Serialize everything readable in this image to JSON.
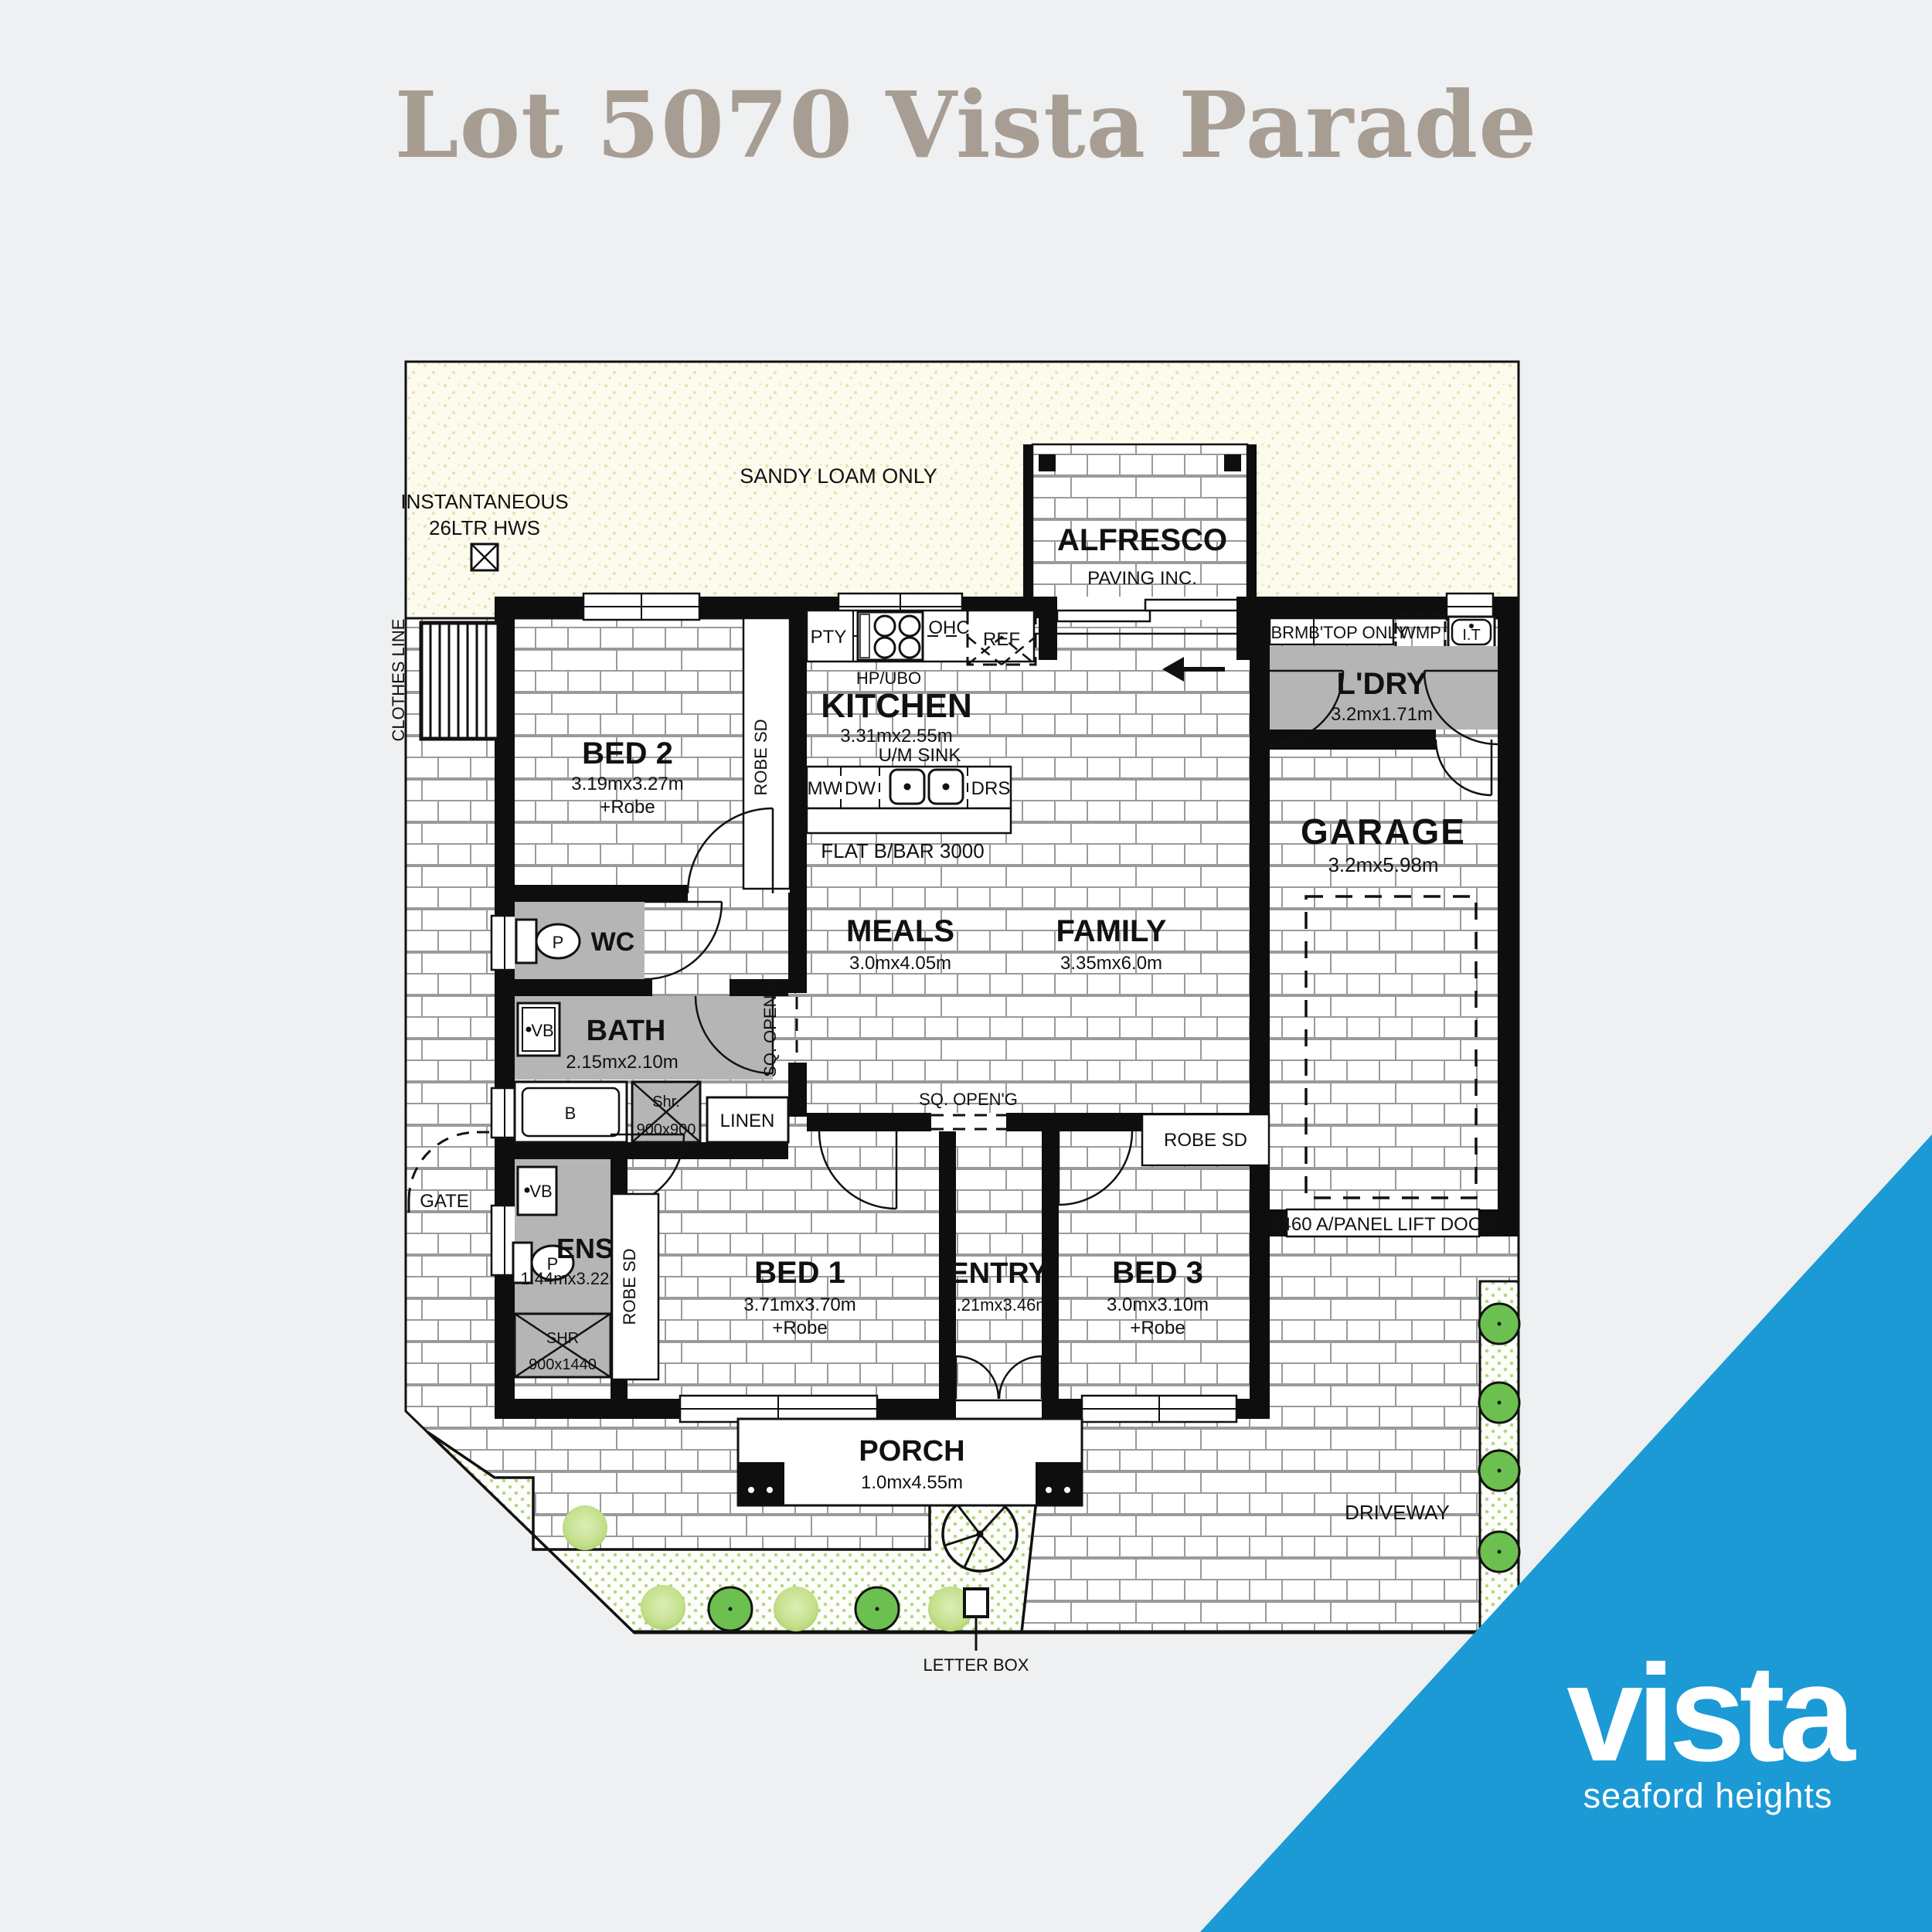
{
  "title": "Lot 5070 Vista Parade",
  "logo": {
    "brand": "vista",
    "tagline": "seaford heights"
  },
  "site": {
    "sandy_loam": "SANDY LOAM ONLY",
    "clothes_line": "CLOTHES LINE",
    "hws_line1": "INSTANTANEOUS",
    "hws_line2": "26LTR HWS",
    "gate": "GATE",
    "driveway": "DRIVEWAY",
    "letter_box": "LETTER BOX",
    "lift_door": "2460 A/PANEL LIFT DOOR"
  },
  "rooms": {
    "alfresco": {
      "name": "ALFRESCO",
      "note": "PAVING INC.",
      "dims": "3.43mx2.73m"
    },
    "kitchen": {
      "name": "KITCHEN",
      "dims": "3.31mx2.55m",
      "note1": "HP/UBO",
      "note2": "U/M SINK",
      "bar": "FLAT B/BAR  3000"
    },
    "bed2": {
      "name": "BED 2",
      "dims": "3.19mx3.27m",
      "extra": "+Robe"
    },
    "wc": {
      "name": "WC"
    },
    "bath": {
      "name": "BATH",
      "dims": "2.15mx2.10m"
    },
    "ens": {
      "name": "ENS",
      "dims": "1.44mx3.22m"
    },
    "bed1": {
      "name": "BED 1",
      "dims": "3.71mx3.70m",
      "extra": "+Robe"
    },
    "entry": {
      "name": "ENTRY",
      "dims": "1.21mx3.46m"
    },
    "bed3": {
      "name": "BED 3",
      "dims": "3.0mx3.10m",
      "extra": "+Robe"
    },
    "meals": {
      "name": "MEALS",
      "dims": "3.0mx4.05m"
    },
    "family": {
      "name": "FAMILY",
      "dims": "3.35mx6.0m"
    },
    "ldry": {
      "name": "L'DRY",
      "dims": "3.2mx1.71m"
    },
    "garage": {
      "name": "GARAGE",
      "dims": "3.2mx5.98m"
    },
    "porch": {
      "name": "PORCH",
      "dims": "1.0mx4.55m"
    },
    "linen": "LINEN"
  },
  "fixtures": {
    "pty": "PTY",
    "ohc": "OHC",
    "ref": "REF",
    "mw": "MW",
    "dw": "DW",
    "drs": "DRS",
    "brm": "BRM.",
    "btop": "B'TOP ONLY",
    "wmp": "WMP",
    "it": "I.T",
    "robe_sd": "ROBE SD",
    "sq_open": "SQ. OPEN'G",
    "shr_small": "Shr.",
    "shr_small_dims": "900x900",
    "shr": "SHR",
    "shr_dims": "900x1440",
    "bath_tub": "B",
    "toilet": "P",
    "vanity": "VB"
  },
  "colors": {
    "accent_blue": "#1b9ad6",
    "title_gray": "#a79d92",
    "room_gray": "#b5b5b5",
    "sandy": "#fcfbee",
    "garden_dot": "#b5d77e",
    "tree_dark": "#6cc04f",
    "tree_light": "#cfe5a2"
  }
}
